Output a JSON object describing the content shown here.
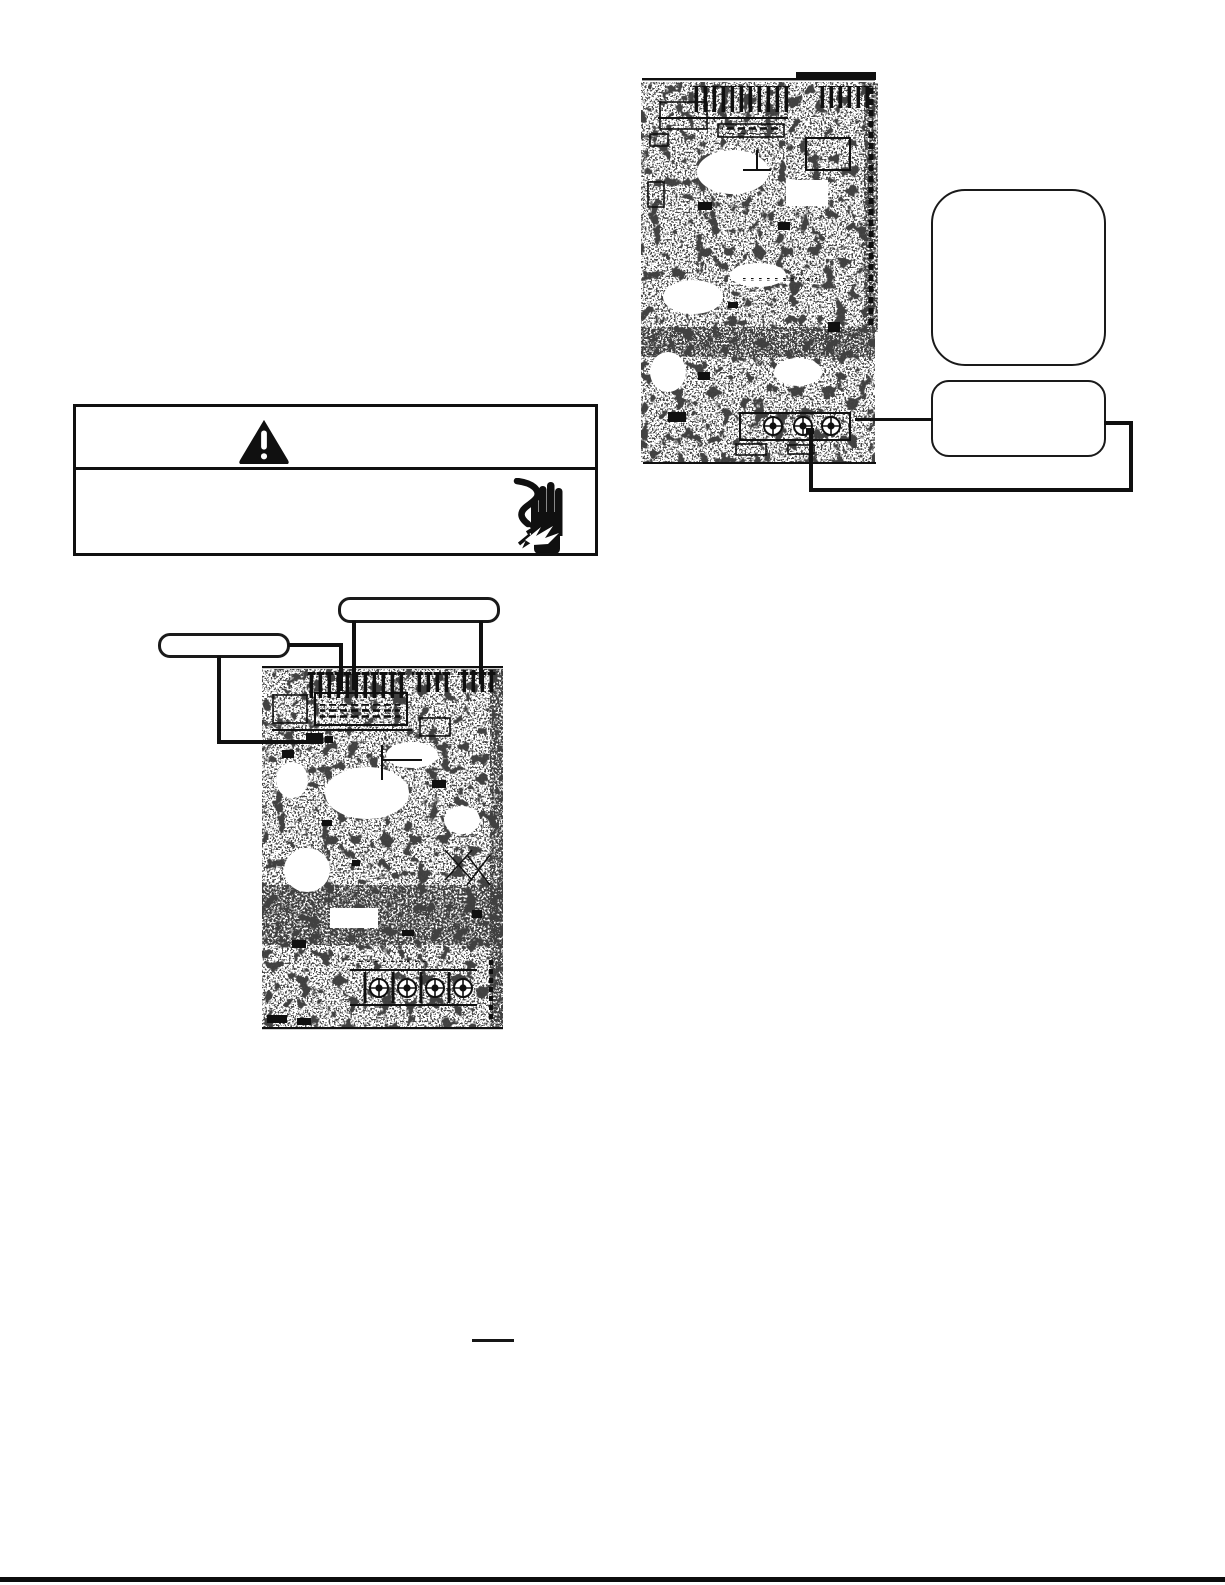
{
  "page": {
    "background": "#ffffff",
    "ink": "#101010",
    "kind": "service-manual-page-scan"
  },
  "warning_box": {
    "icons": [
      "warning-triangle-icon",
      "electric-shock-hand-icon"
    ],
    "text": ""
  },
  "figures": {
    "top_right_pcb": {
      "kind": "circuit-board-scan",
      "label": ""
    },
    "left_pcb": {
      "kind": "circuit-board-scan",
      "label": ""
    }
  },
  "callouts": {
    "right_large": {
      "label": ""
    },
    "right_small": {
      "label": ""
    },
    "left_top": {
      "label": ""
    },
    "left_side": {
      "label": ""
    }
  }
}
